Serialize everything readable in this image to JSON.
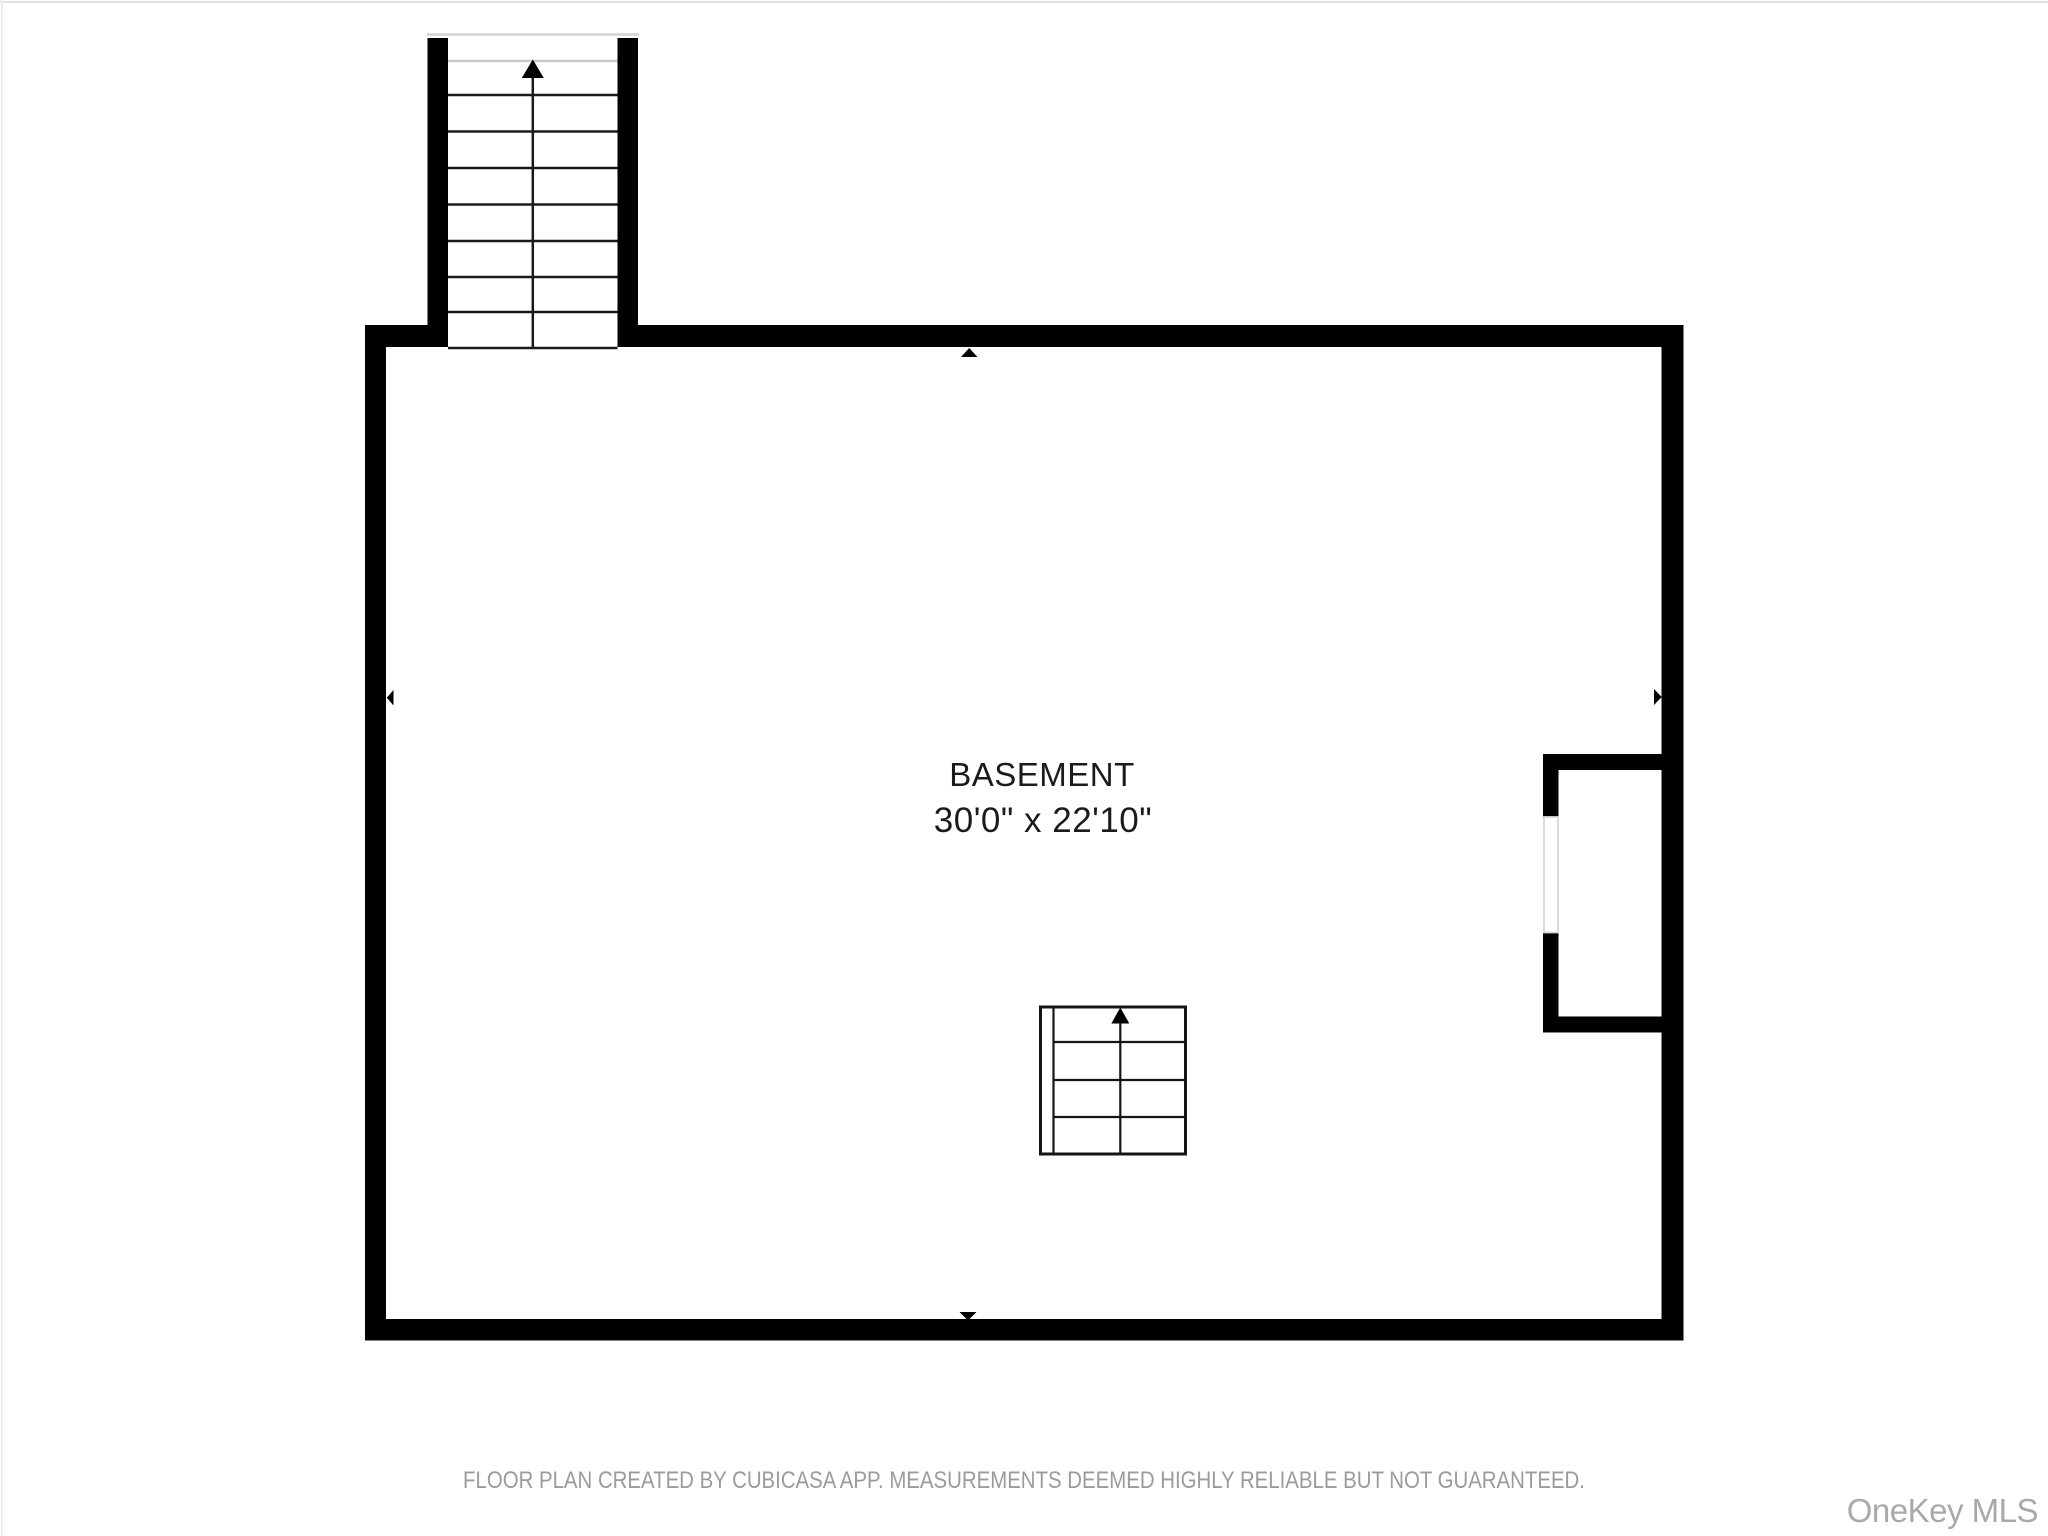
{
  "floor_plan": {
    "room": {
      "name": "BASEMENT",
      "dimensions": "30'0\" x 22'10\""
    },
    "features": {
      "upper_staircase": "staircase leading up, exiting through top wall",
      "basement_staircase": "small staircase symbol inside room, arrow up",
      "alcove": "recessed closet on right wall with wall opening",
      "wall_markers": [
        "top",
        "left",
        "right",
        "bottom"
      ]
    }
  },
  "icons": {
    "upper_stairs_arrow": "triangle-up",
    "basement_stairs_arrow": "triangle-up",
    "wall_marker_top": "triangle-up",
    "wall_marker_bottom": "triangle-down",
    "wall_marker_left": "triangle-left",
    "wall_marker_right": "triangle-right"
  },
  "footer": {
    "disclaimer": "FLOOR PLAN CREATED BY CUBICASA APP. MEASUREMENTS DEEMED HIGHLY RELIABLE BUT NOT GUARANTEED."
  },
  "watermark": {
    "text": "OneKey MLS"
  },
  "colors": {
    "wall": "#000000",
    "tread": "#1a1a1a",
    "light-line": "#c9c9c9",
    "opening": "#d9d9d9",
    "label": "#1b1b1b",
    "footer": "#9b9b9b",
    "watermark": "#a9a9a9",
    "bg": "#ffffff",
    "edge": "#e0e0e0"
  }
}
